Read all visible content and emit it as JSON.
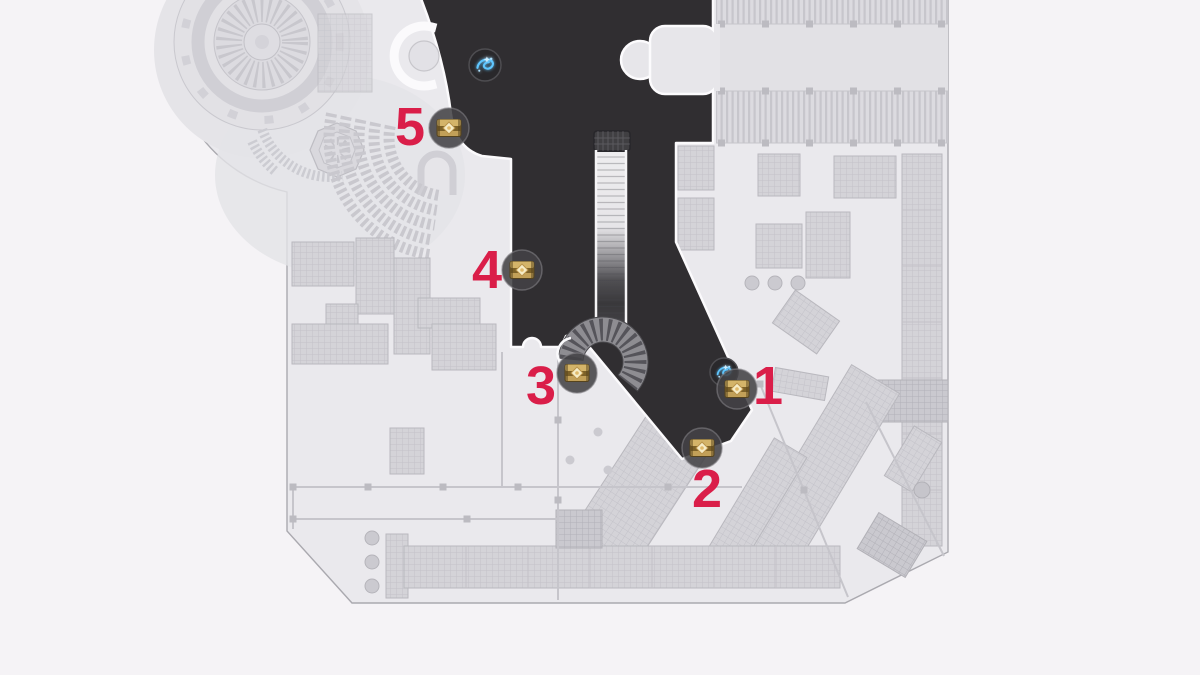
{
  "map": {
    "markers": [
      {
        "label": "1",
        "type": "treasure-chest",
        "icon": "chest-icon",
        "companion_icon": "luminous-item-icon"
      },
      {
        "label": "2",
        "type": "treasure-chest",
        "icon": "chest-icon"
      },
      {
        "label": "3",
        "type": "treasure-chest",
        "icon": "chest-icon"
      },
      {
        "label": "4",
        "type": "treasure-chest",
        "icon": "chest-icon"
      },
      {
        "label": "5",
        "type": "treasure-chest",
        "icon": "chest-icon"
      }
    ],
    "floating_icons": [
      {
        "icon": "luminous-item-icon"
      }
    ],
    "colors": {
      "background": "#f5f3f6",
      "map_base": "#eae9ed",
      "buildings": "#d4d3d8",
      "dark_zone": "#302e31",
      "marker_number": "#da1e49",
      "chest_gold": "#c9a55a",
      "item_blue": "#5ec6ff"
    }
  }
}
